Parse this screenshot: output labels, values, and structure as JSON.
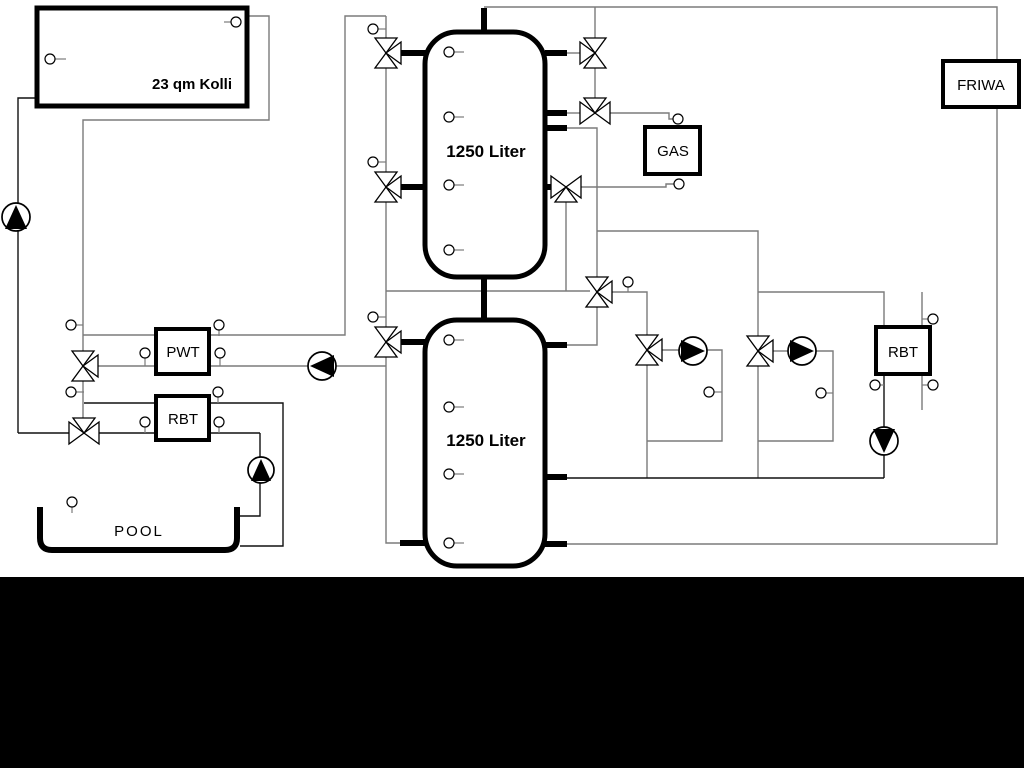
{
  "diagram": {
    "labels": {
      "collector": "23 qm Kolli",
      "tank1": "1250 Liter",
      "tank2": "1250 Liter",
      "gas": "GAS",
      "friwa": "FRIWA",
      "pwt": "PWT",
      "rbt_left": "RBT",
      "rbt_right": "RBT",
      "pool": "POOL"
    },
    "colors": {
      "background": "#ffffff",
      "bottom_band": "#000000",
      "pipe_gray": "#7b7b7b",
      "pipe_black": "#111111",
      "component_fill": "#ffffff",
      "component_stroke": "#000000"
    },
    "components": {
      "storage_tanks": 2,
      "three_way_valves": 11,
      "temperature_sensors": 30,
      "pumps": [
        {
          "id": "solar-pump",
          "direction": "up"
        },
        {
          "id": "pwt-pump",
          "direction": "left"
        },
        {
          "id": "pool-pump",
          "direction": "up"
        },
        {
          "id": "heating-circuit-pump-1",
          "direction": "right"
        },
        {
          "id": "heating-circuit-pump-2",
          "direction": "right"
        },
        {
          "id": "rbt-pump",
          "direction": "down"
        }
      ]
    }
  }
}
